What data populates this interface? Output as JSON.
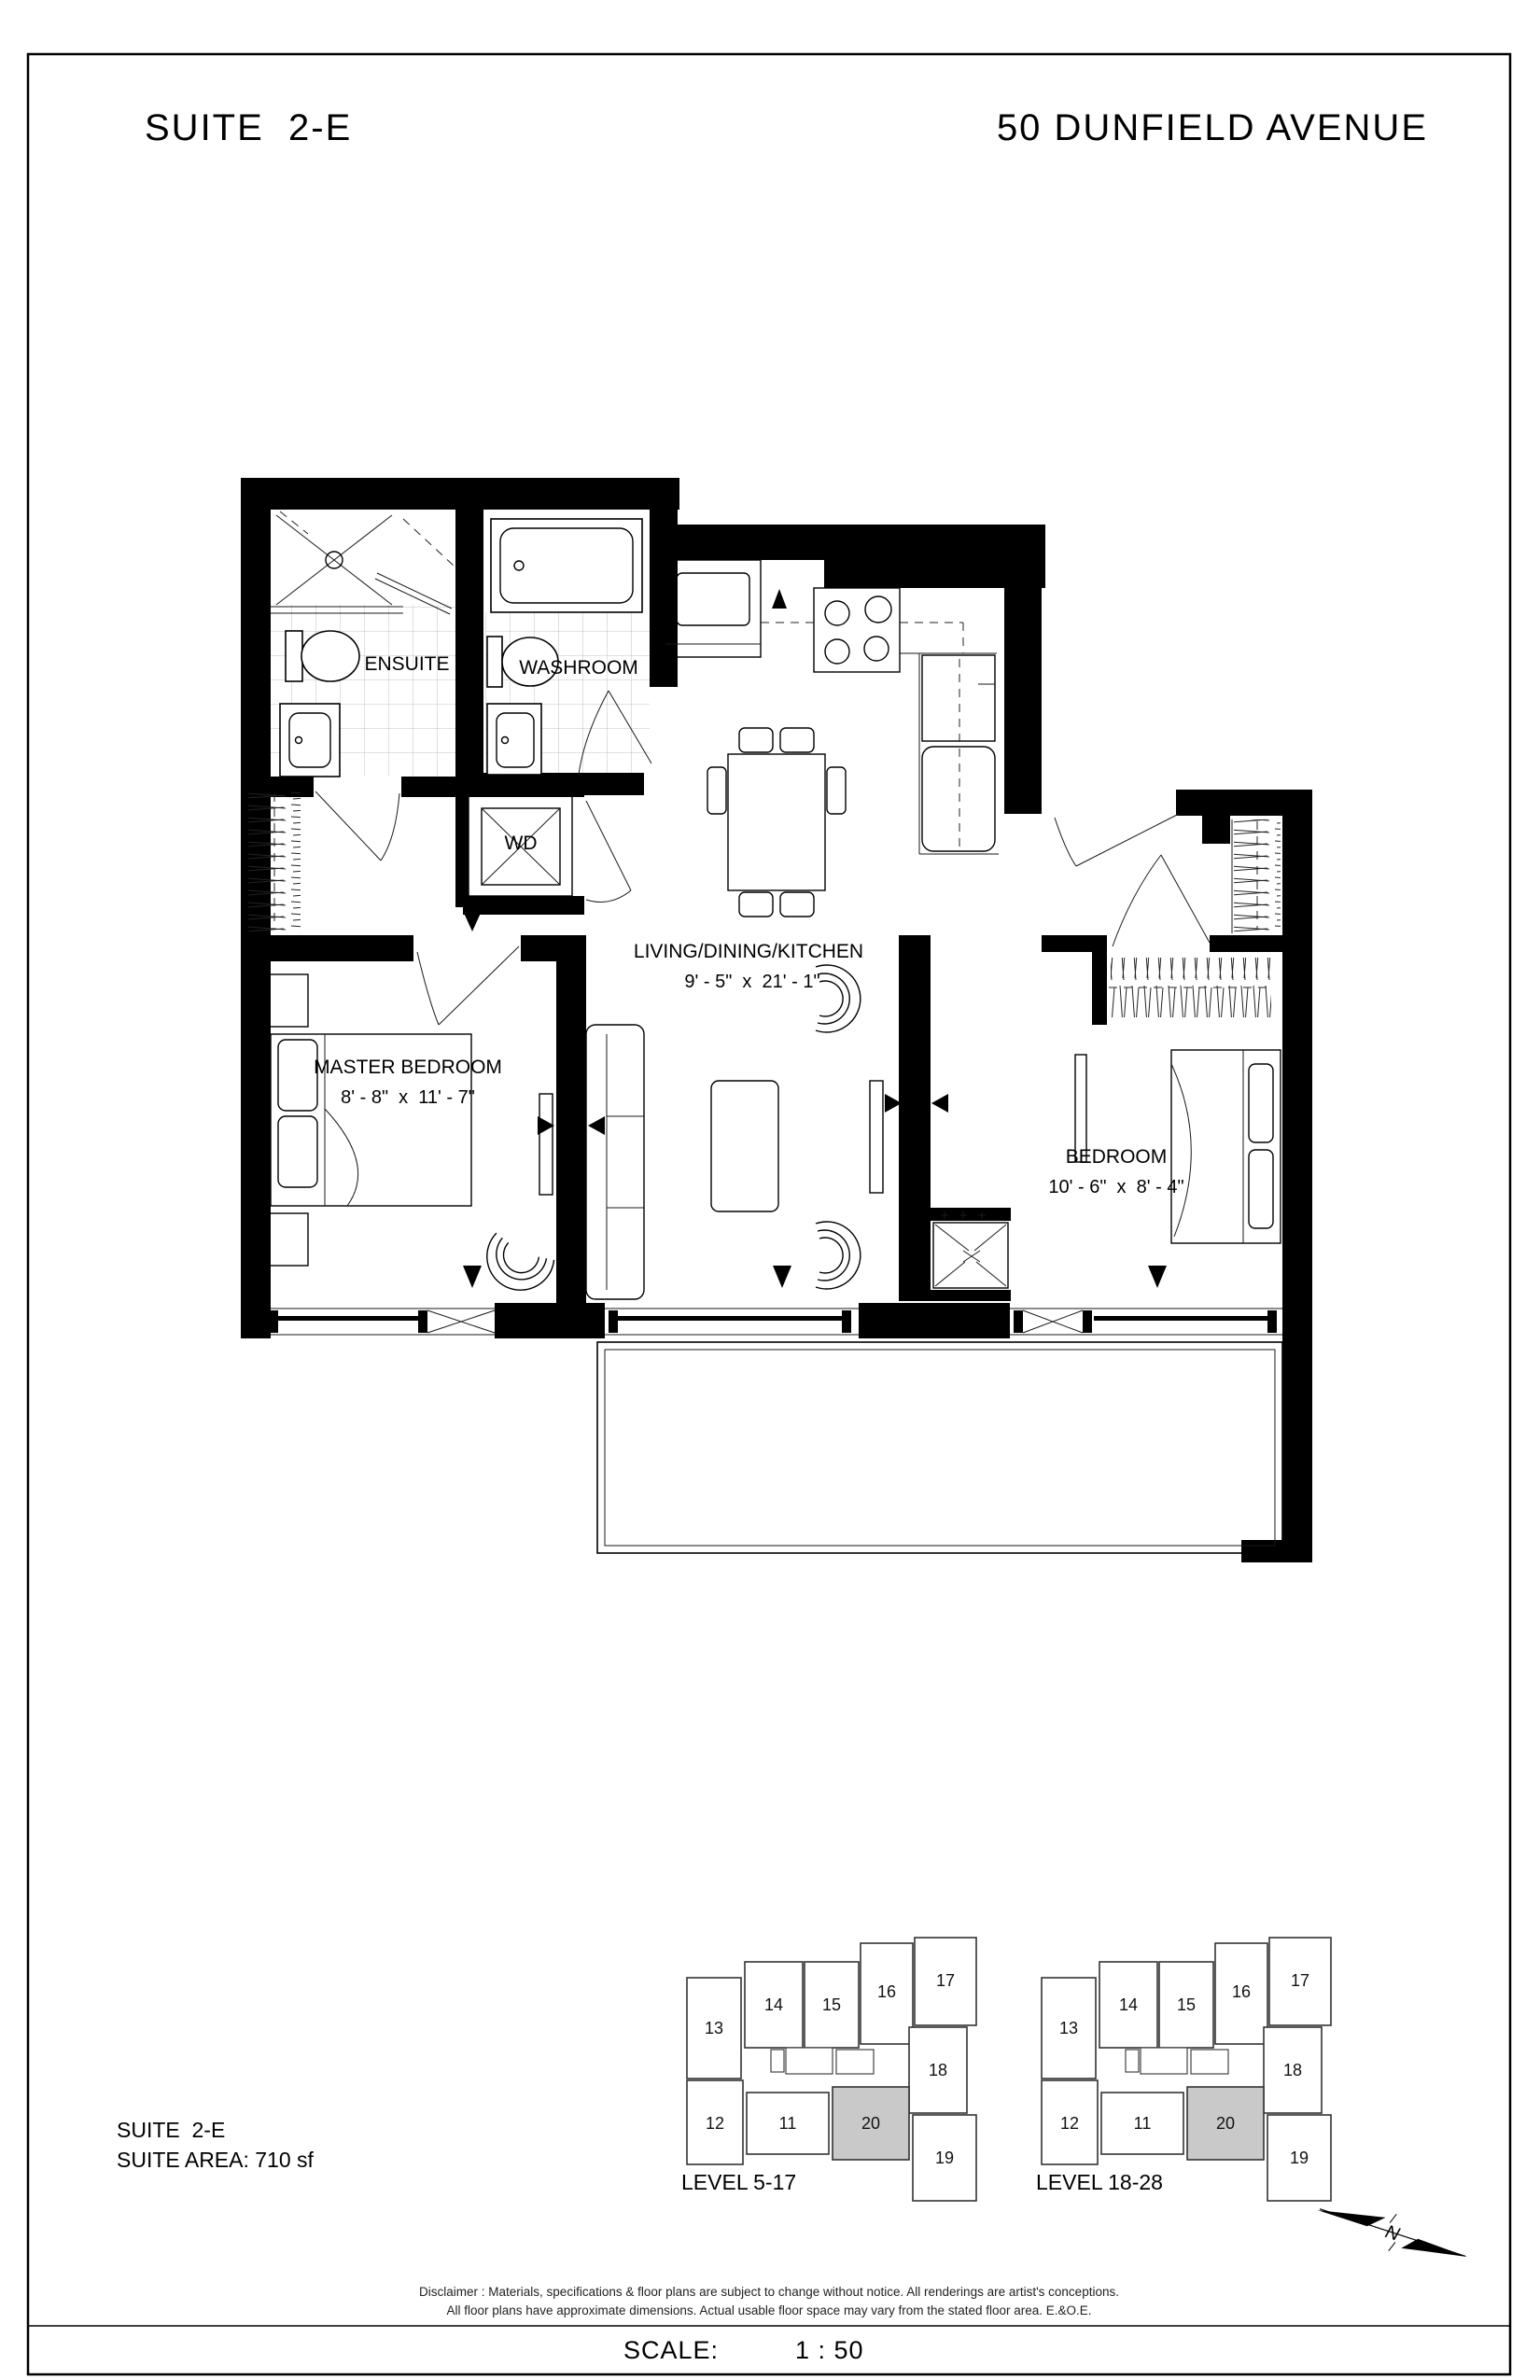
{
  "header": {
    "suite_title": "SUITE  2-E",
    "address": "50 DUNFIELD AVENUE"
  },
  "plan": {
    "rooms": {
      "ensuite": {
        "label": "ENSUITE"
      },
      "washroom": {
        "label": "WASHROOM"
      },
      "wd": {
        "label": "WD"
      },
      "living": {
        "label": "LIVING/DINING/KITCHEN",
        "dims": "9' - 5\"  x  21' - 1\""
      },
      "master": {
        "label": "MASTER BEDROOM",
        "dims": "8' - 8\"  x  11' - 7\""
      },
      "bedroom": {
        "label": "BEDROOM",
        "dims": "10' - 6\"  x  8' - 4\""
      }
    }
  },
  "suite_info": {
    "name": "SUITE  2-E",
    "area": "SUITE AREA: 710 sf"
  },
  "keyplans": {
    "units": [
      "11",
      "12",
      "13",
      "14",
      "15",
      "16",
      "17",
      "18",
      "19",
      "20"
    ],
    "highlighted_unit": "20",
    "plans": [
      {
        "label": "LEVEL 5-17"
      },
      {
        "label": "LEVEL 18-28"
      }
    ]
  },
  "north_indicator": {
    "label": "N"
  },
  "disclaimer": {
    "line1": "Disclaimer : Materials, specifications & floor plans are subject to change without notice. All renderings are artist's conceptions.",
    "line2": "All floor plans have approximate dimensions. Actual usable floor space may vary from the stated floor area. E.&O.E."
  },
  "footer": {
    "scale_label": "SCALE:",
    "scale_value": "1 : 50"
  },
  "colors": {
    "wall": "#000000",
    "highlight_unit_fill": "#c9c9c9",
    "tile_line": "#b0b0b0",
    "paper": "#ffffff"
  }
}
